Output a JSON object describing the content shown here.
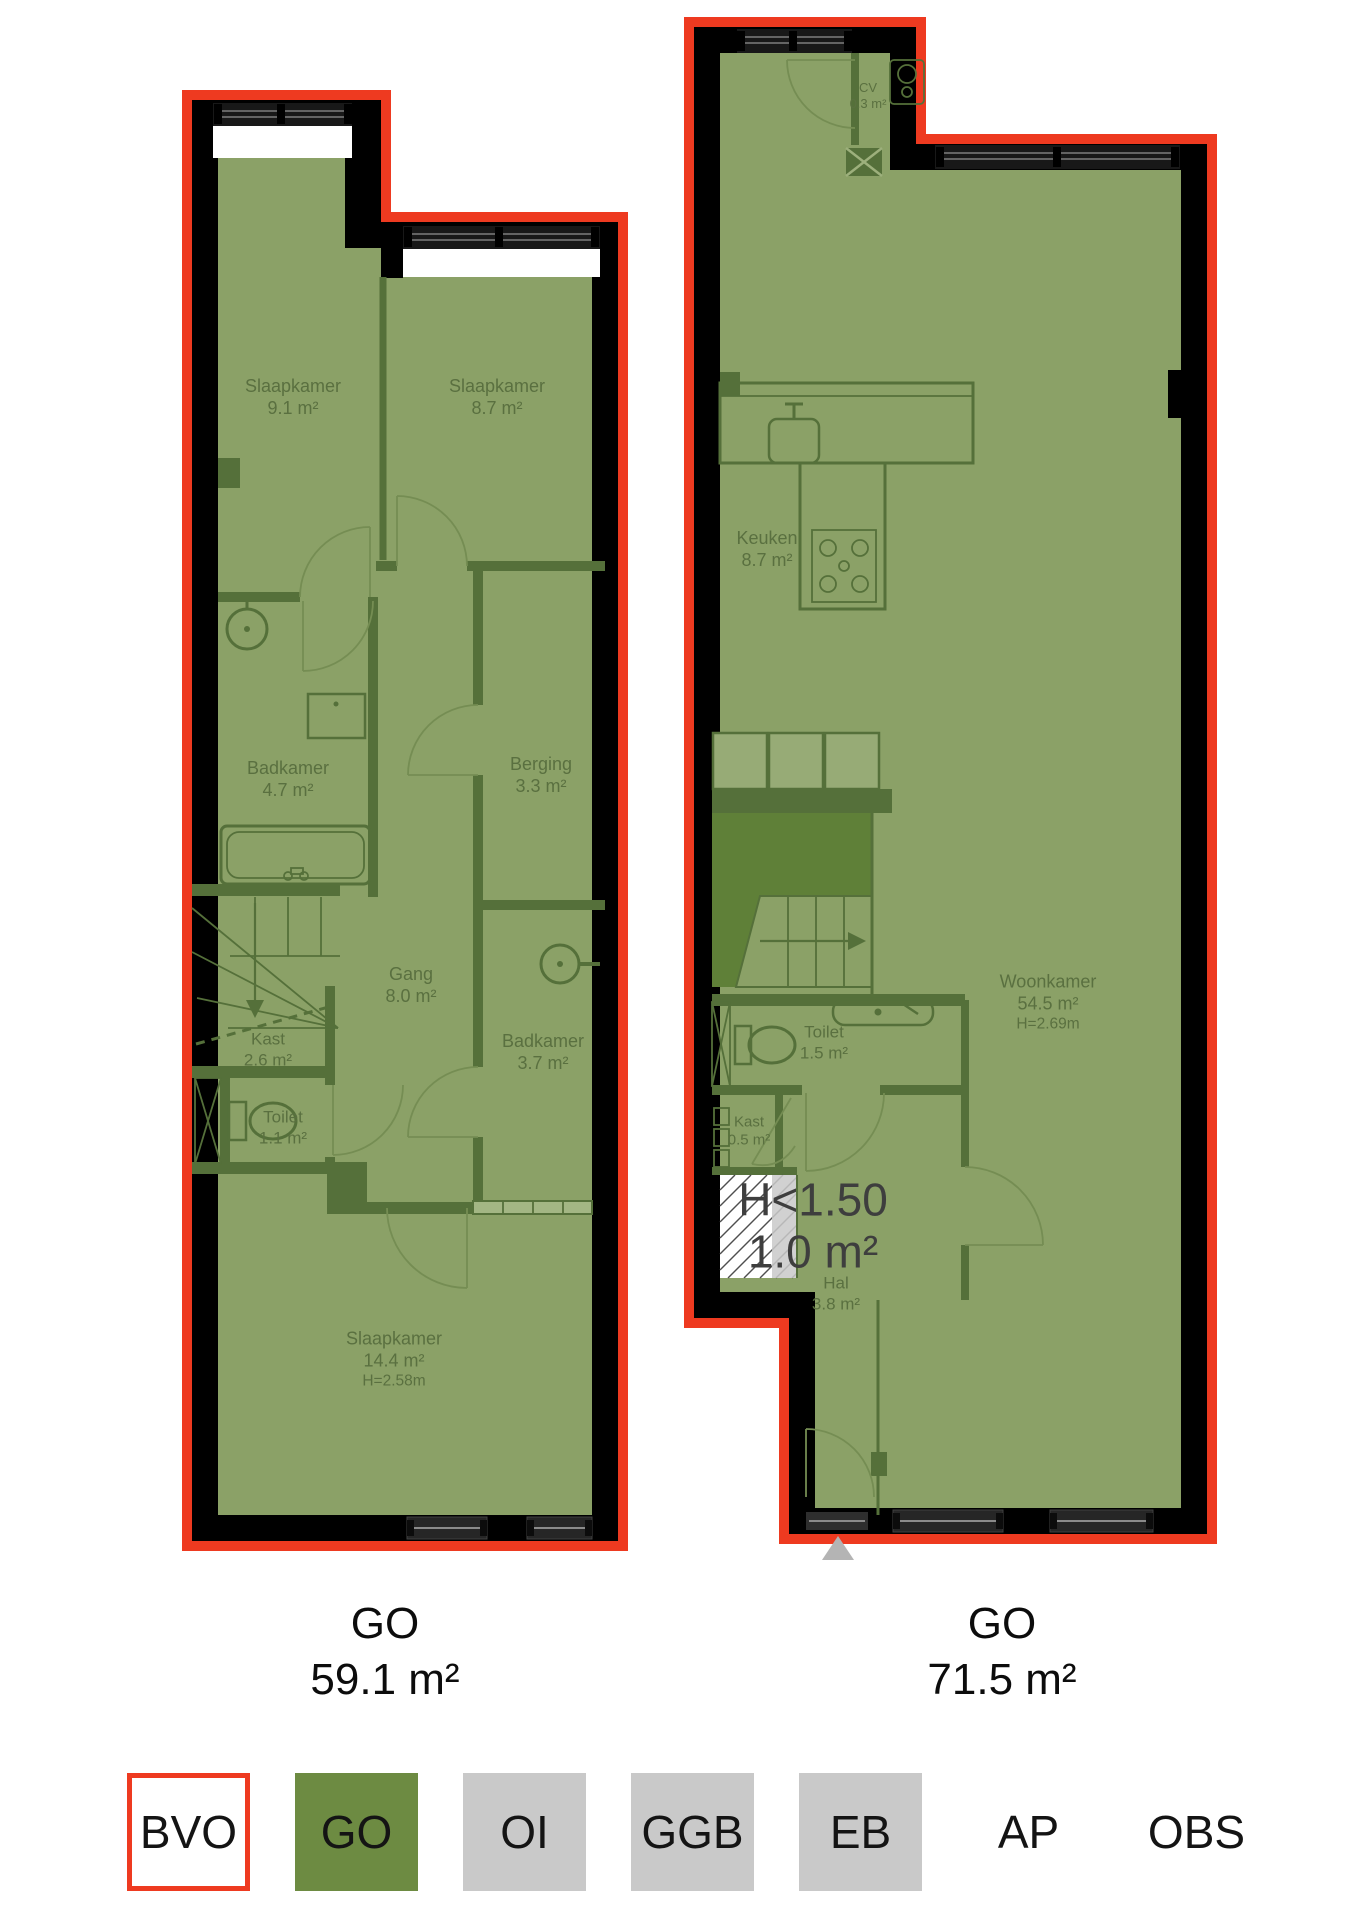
{
  "colors": {
    "bvo_outline_red": "#ee3a20",
    "go_fill_green": "#8ba167",
    "inner_wall_green": "#55703a",
    "void_green": "#5f8038",
    "wall_black": "#000000",
    "legend_go_green": "#6d8b42",
    "legend_gray": "#c9c9c9",
    "room_label_green": "#5a7040",
    "annotation_gray": "#3e3e3e",
    "entrance_marker_gray": "#b4b4b4"
  },
  "plans": [
    {
      "footer": {
        "type_label": "GO",
        "area": "59.1 m²"
      },
      "rooms": [
        {
          "name": "Slaapkamer",
          "area": "9.1 m²"
        },
        {
          "name": "Slaapkamer",
          "area": "8.7 m²"
        },
        {
          "name": "Badkamer",
          "area": "4.7 m²"
        },
        {
          "name": "Berging",
          "area": "3.3 m²"
        },
        {
          "name": "Gang",
          "area": "8.0 m²"
        },
        {
          "name": "Kast",
          "area": "2.6 m²"
        },
        {
          "name": "Badkamer",
          "area": "3.7 m²"
        },
        {
          "name": "Toilet",
          "area": "1.1 m²"
        },
        {
          "name": "Slaapkamer",
          "area": "14.4 m²",
          "height": "H=2.58m"
        }
      ]
    },
    {
      "footer": {
        "type_label": "GO",
        "area": "71.5 m²"
      },
      "rooms": [
        {
          "name": "CV",
          "area": "0.3 m²"
        },
        {
          "name": "Keuken",
          "area": "8.7 m²"
        },
        {
          "name": "Woonkamer",
          "area": "54.5 m²",
          "height": "H=2.69m"
        },
        {
          "name": "Toilet",
          "area": "1.5 m²"
        },
        {
          "name": "Kast",
          "area": "0.5 m²"
        },
        {
          "name": "Hal",
          "area": "3.8 m²"
        }
      ],
      "annotation": {
        "label": "H<1.50",
        "area": "1.0 m²"
      }
    }
  ],
  "legend": {
    "items": [
      {
        "label": "BVO",
        "fill": "#ffffff",
        "border": "#ee3a20"
      },
      {
        "label": "GO",
        "fill": "#6d8b42",
        "border": ""
      },
      {
        "label": "OI",
        "fill": "#c9c9c9",
        "border": ""
      },
      {
        "label": "GGB",
        "fill": "#c9c9c9",
        "border": ""
      },
      {
        "label": "EB",
        "fill": "#c9c9c9",
        "border": ""
      },
      {
        "label": "AP",
        "fill": "",
        "border": ""
      },
      {
        "label": "OBS",
        "fill": "",
        "border": ""
      }
    ]
  }
}
